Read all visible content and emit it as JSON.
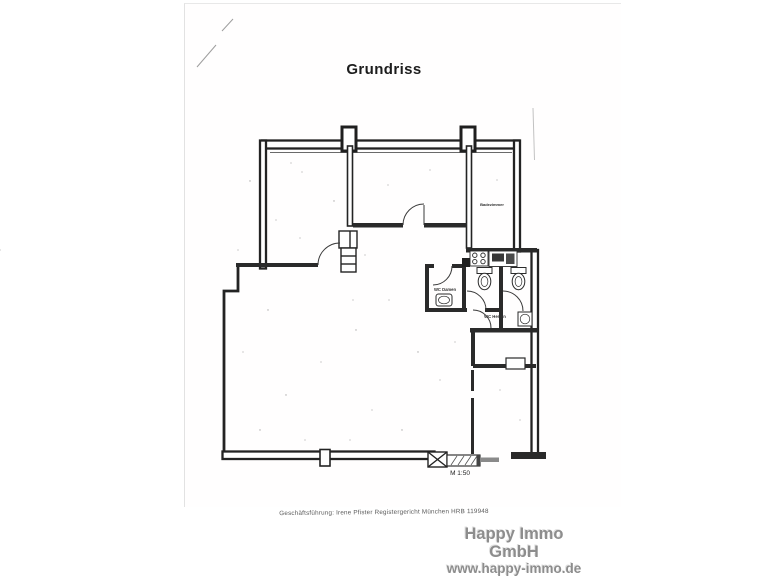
{
  "document": {
    "title": "Grundriss",
    "footer": "Geschäftsführung: Irene Pfister Registergericht München HRB 119948"
  },
  "plan": {
    "scale_label": "M 1:50",
    "labels": {
      "room_top_right": "Badezimmer",
      "wc_damen": "WC Damen",
      "wc_herren": "WC Herren"
    }
  },
  "branding": {
    "company": "Happy Immo GmbH",
    "website": "www.happy-immo.de"
  },
  "colors": {
    "wall": "#232323",
    "paper": "#ffffff",
    "logo_gray": "#8d8d8d",
    "scan_noise": "#ababab"
  }
}
